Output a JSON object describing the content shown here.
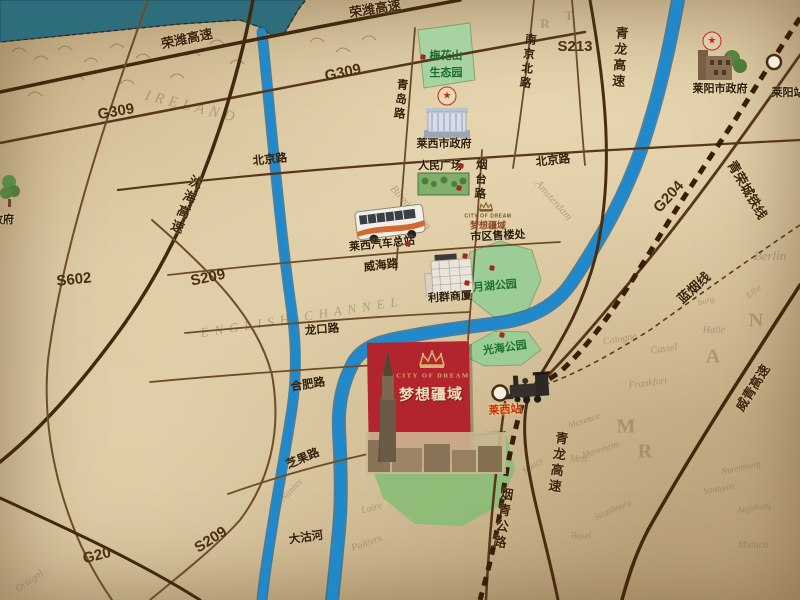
{
  "colors": {
    "paper": "#d8c49c",
    "sea": "#2e6e7c",
    "river": "#1f81c2",
    "road_dark": "#42280c",
    "road_mid": "#57361a",
    "road_thin": "#6e4c28",
    "railway": "#381f04",
    "park": "#a8d3a0",
    "lawn": "#8cbc77",
    "logo_red": "#b2252e",
    "logo_gold": "#d8b06a",
    "star_red": "#c8281c",
    "dot_red": "#a5281c",
    "park_text": "#1d6e2e",
    "station_text_red": "#c2281a",
    "label_brown": "#33200a"
  },
  "icons": {
    "star": "★",
    "crown": "crown-icon",
    "government_building": "government-building-icon",
    "bus": "bus-icon",
    "locomotive": "locomotive-icon",
    "tree": "tree-icon"
  },
  "logo": {
    "english": "CITY OF DREAM",
    "chinese": "梦想疆域"
  },
  "map_labels": [
    {
      "name": "rongwei-expwy-1",
      "text": "荣潍高速",
      "x": 187,
      "y": 39,
      "rot": -12,
      "cls": "hwy"
    },
    {
      "name": "rongwei-expwy-2",
      "text": "荣潍高速",
      "x": 375,
      "y": 9,
      "rot": -9,
      "cls": "hwy"
    },
    {
      "name": "shenhai-expwy",
      "text": "沈海高速",
      "x": 185,
      "y": 205,
      "rot": 22,
      "cls": "hwy",
      "vert": true
    },
    {
      "name": "qinglong-expwy-north",
      "text": "青龙高速",
      "x": 619,
      "y": 58,
      "rot": 4,
      "cls": "hwy",
      "vert": true
    },
    {
      "name": "qinglong-expwy-south",
      "text": "青龙高速",
      "x": 557,
      "y": 463,
      "rot": 8,
      "cls": "hwy",
      "vert": true
    },
    {
      "name": "weiqing-expwy",
      "text": "威青高速",
      "x": 753,
      "y": 388,
      "rot": -58,
      "cls": "hwy"
    },
    {
      "name": "yanqing-highway",
      "text": "烟青公路",
      "x": 502,
      "y": 519,
      "rot": 8,
      "cls": "hwy",
      "vert": true
    },
    {
      "name": "qingrong-intercity-rail",
      "text": "青荣城铁线",
      "x": 747,
      "y": 190,
      "rot": 60,
      "cls": "hwy"
    },
    {
      "name": "lanyan-rail",
      "text": "蓝烟线",
      "x": 694,
      "y": 288,
      "rot": -42,
      "cls": "hwy"
    },
    {
      "name": "route-g309-west",
      "text": "G309",
      "x": 116,
      "y": 112,
      "rot": -10,
      "cls": "shield"
    },
    {
      "name": "route-g309-east",
      "text": "G309",
      "x": 343,
      "y": 73,
      "rot": -12,
      "cls": "shield"
    },
    {
      "name": "route-s602",
      "text": "S602",
      "x": 74,
      "y": 280,
      "rot": -6,
      "cls": "shield"
    },
    {
      "name": "route-s209-north",
      "text": "S209",
      "x": 208,
      "y": 278,
      "rot": -12,
      "cls": "shield"
    },
    {
      "name": "route-s209-south",
      "text": "S209",
      "x": 211,
      "y": 540,
      "rot": -33,
      "cls": "shield"
    },
    {
      "name": "route-s213",
      "text": "S213",
      "x": 575,
      "y": 47,
      "rot": 0,
      "cls": "shield"
    },
    {
      "name": "route-g204",
      "text": "G204",
      "x": 669,
      "y": 197,
      "rot": -48,
      "cls": "shield"
    },
    {
      "name": "route-g20",
      "text": "G20",
      "x": 97,
      "y": 556,
      "rot": -14,
      "cls": "shield"
    },
    {
      "name": "beijing-road-west",
      "text": "北京路",
      "x": 270,
      "y": 160,
      "rot": -6,
      "cls": "road"
    },
    {
      "name": "beijing-road-east",
      "text": "北京路",
      "x": 553,
      "y": 161,
      "rot": -6,
      "cls": "road"
    },
    {
      "name": "qingdao-road",
      "text": "青岛路",
      "x": 400,
      "y": 100,
      "rot": 6,
      "cls": "road",
      "vert": true
    },
    {
      "name": "nanjing-north-road",
      "text": "南京北路",
      "x": 527,
      "y": 62,
      "rot": 7,
      "cls": "road",
      "vert": true
    },
    {
      "name": "yantai-road",
      "text": "烟台路",
      "x": 480,
      "y": 180,
      "rot": 3,
      "cls": "road",
      "vert": true
    },
    {
      "name": "weihai-road",
      "text": "威海路",
      "x": 381,
      "y": 266,
      "rot": -7,
      "cls": "road"
    },
    {
      "name": "longkou-road",
      "text": "龙口路",
      "x": 322,
      "y": 330,
      "rot": -5,
      "cls": "road"
    },
    {
      "name": "hefei-road",
      "text": "合肥路",
      "x": 308,
      "y": 385,
      "rot": -9,
      "cls": "road"
    },
    {
      "name": "zhiguo-road",
      "text": "芝果路",
      "x": 303,
      "y": 459,
      "rot": -23,
      "cls": "road"
    },
    {
      "name": "dagu-river",
      "text": "大沽河",
      "x": 306,
      "y": 538,
      "rot": -8,
      "cls": "road"
    },
    {
      "name": "laixi-city-government",
      "text": "莱西市政府",
      "x": 444,
      "y": 145,
      "rot": 0,
      "cls": "poi"
    },
    {
      "name": "peoples-square",
      "text": "人民广场",
      "x": 440,
      "y": 167,
      "rot": 0,
      "cls": "poi"
    },
    {
      "name": "laixi-bus-terminal",
      "text": "莱西汽车总站",
      "x": 382,
      "y": 245,
      "rot": -6,
      "cls": "poi"
    },
    {
      "name": "liqun-shopping-mall",
      "text": "利群商厦",
      "x": 450,
      "y": 298,
      "rot": -4,
      "cls": "poi"
    },
    {
      "name": "downtown-sales-office",
      "text": "市区售楼处",
      "x": 498,
      "y": 237,
      "rot": -3,
      "cls": "poi"
    },
    {
      "name": "laiyang-city-government",
      "text": "莱阳市政府",
      "x": 720,
      "y": 90,
      "rot": 0,
      "cls": "poi"
    },
    {
      "name": "laiyang-station",
      "text": "莱阳站",
      "x": 788,
      "y": 94,
      "rot": 0,
      "cls": "poi"
    },
    {
      "name": "government-partial",
      "text": "政府",
      "x": 3,
      "y": 221,
      "rot": 0,
      "cls": "poi"
    },
    {
      "name": "meihuashan-park-line1",
      "text": "梅花山",
      "x": 446,
      "y": 57,
      "rot": 0,
      "cls": "park"
    },
    {
      "name": "meihuashan-park-line2",
      "text": "生态园",
      "x": 446,
      "y": 74,
      "rot": 0,
      "cls": "park"
    },
    {
      "name": "yuehu-park",
      "text": "月湖公园",
      "x": 495,
      "y": 287,
      "rot": -5,
      "cls": "park"
    },
    {
      "name": "guanghai-park",
      "text": "光海公园",
      "x": 505,
      "y": 349,
      "rot": -8,
      "cls": "park"
    },
    {
      "name": "laixi-station",
      "text": "莱西站",
      "x": 505,
      "y": 411,
      "rot": -3,
      "cls": "stn"
    },
    {
      "name": "ghost-ireland",
      "text": "IRELAND",
      "x": 192,
      "y": 108,
      "rot": 14,
      "cls": "ghost",
      "size": 15,
      "sp": 5
    },
    {
      "name": "ghost-birmingham",
      "text": "Birmingham",
      "x": 410,
      "y": 208,
      "rot": 48,
      "cls": "ghost",
      "size": 11
    },
    {
      "name": "ghost-amsterdam",
      "text": "Amsterdam",
      "x": 553,
      "y": 201,
      "rot": 48,
      "cls": "ghost",
      "size": 11
    },
    {
      "name": "ghost-english-channel",
      "text": "ENGLISH CHANNEL",
      "x": 302,
      "y": 317,
      "rot": -9,
      "cls": "ghost",
      "size": 13,
      "sp": 6
    },
    {
      "name": "ghost-nantes",
      "text": "Nantes",
      "x": 292,
      "y": 491,
      "rot": -45,
      "cls": "ghost"
    },
    {
      "name": "ghost-loire",
      "text": "Loire",
      "x": 372,
      "y": 509,
      "rot": -15,
      "cls": "ghost"
    },
    {
      "name": "ghost-poitiers",
      "text": "Poitiers",
      "x": 367,
      "y": 544,
      "rot": -20,
      "cls": "ghost"
    },
    {
      "name": "ghost-ortegal",
      "text": "Ortegal",
      "x": 30,
      "y": 582,
      "rot": -35,
      "cls": "ghost"
    },
    {
      "name": "ghost-berlin",
      "text": "Berlin",
      "x": 770,
      "y": 256,
      "rot": 0,
      "cls": "ghost",
      "size": 13
    },
    {
      "name": "ghost-elbe",
      "text": "Elbe",
      "x": 754,
      "y": 292,
      "rot": -38,
      "cls": "ghost",
      "size": 9
    },
    {
      "name": "ghost-halle",
      "text": "Halle",
      "x": 714,
      "y": 331,
      "rot": 0,
      "cls": "ghost"
    },
    {
      "name": "ghost-cassel",
      "text": "Cassel",
      "x": 664,
      "y": 350,
      "rot": -8,
      "cls": "ghost"
    },
    {
      "name": "ghost-cologne",
      "text": "Cologne",
      "x": 620,
      "y": 340,
      "rot": -10,
      "cls": "ghost"
    },
    {
      "name": "ghost-frankfort",
      "text": "Frankfort",
      "x": 648,
      "y": 384,
      "rot": -8,
      "cls": "ghost"
    },
    {
      "name": "ghost-mayence",
      "text": "Mayence",
      "x": 584,
      "y": 421,
      "rot": -18,
      "cls": "ghost",
      "size": 9
    },
    {
      "name": "ghost-mannheim",
      "text": "Mannheim",
      "x": 601,
      "y": 450,
      "rot": -18,
      "cls": "ghost",
      "size": 9
    },
    {
      "name": "ghost-nancy",
      "text": "Nancy",
      "x": 533,
      "y": 466,
      "rot": -35,
      "cls": "ghost",
      "size": 9
    },
    {
      "name": "ghost-metz",
      "text": "Metz",
      "x": 579,
      "y": 459,
      "rot": 0,
      "cls": "ghost",
      "size": 9
    },
    {
      "name": "ghost-strasbourg",
      "text": "Strasbourg",
      "x": 613,
      "y": 510,
      "rot": -25,
      "cls": "ghost",
      "size": 9
    },
    {
      "name": "ghost-basel",
      "text": "Basel",
      "x": 581,
      "y": 536,
      "rot": 0,
      "cls": "ghost",
      "size": 9
    },
    {
      "name": "ghost-nuremberg",
      "text": "Nuremberg",
      "x": 741,
      "y": 468,
      "rot": -12,
      "cls": "ghost",
      "size": 9
    },
    {
      "name": "ghost-stuttgart",
      "text": "Stuttgart",
      "x": 719,
      "y": 489,
      "rot": -10,
      "cls": "ghost",
      "size": 9
    },
    {
      "name": "ghost-augsburg",
      "text": "Augsburg",
      "x": 754,
      "y": 508,
      "rot": -10,
      "cls": "ghost",
      "size": 9
    },
    {
      "name": "ghost-munich",
      "text": "Munich",
      "x": 753,
      "y": 546,
      "rot": 0,
      "cls": "ghost"
    },
    {
      "name": "ghost-burg",
      "text": "burg",
      "x": 706,
      "y": 301,
      "rot": -15,
      "cls": "ghost",
      "size": 9
    },
    {
      "name": "ghost-letter-n",
      "text": "N",
      "x": 757,
      "y": 321,
      "rot": 0,
      "cls": "ghostbig"
    },
    {
      "name": "ghost-letter-a",
      "text": "A",
      "x": 714,
      "y": 357,
      "rot": 0,
      "cls": "ghostbig"
    },
    {
      "name": "ghost-letter-m",
      "text": "M",
      "x": 627,
      "y": 427,
      "rot": 0,
      "cls": "ghostbig"
    },
    {
      "name": "ghost-letter-r",
      "text": "R",
      "x": 646,
      "y": 452,
      "rot": 0,
      "cls": "ghostbig"
    },
    {
      "name": "ghost-letter-r2",
      "text": "R",
      "x": 546,
      "y": 24,
      "rot": 0,
      "cls": "ghostbig",
      "size": 13
    },
    {
      "name": "ghost-letter-t",
      "text": "T",
      "x": 570,
      "y": 16,
      "rot": 0,
      "cls": "ghostbig",
      "size": 13
    }
  ],
  "poi_dots": [
    {
      "x": 423,
      "y": 57
    },
    {
      "x": 461,
      "y": 166
    },
    {
      "x": 459,
      "y": 188
    },
    {
      "x": 408,
      "y": 244
    },
    {
      "x": 467,
      "y": 283
    },
    {
      "x": 465,
      "y": 256
    },
    {
      "x": 492,
      "y": 268
    },
    {
      "x": 502,
      "y": 335
    }
  ],
  "stars": [
    {
      "name": "laixi-government-star",
      "x": 447,
      "y": 96
    },
    {
      "name": "laiyang-government-star",
      "x": 712,
      "y": 41
    }
  ]
}
